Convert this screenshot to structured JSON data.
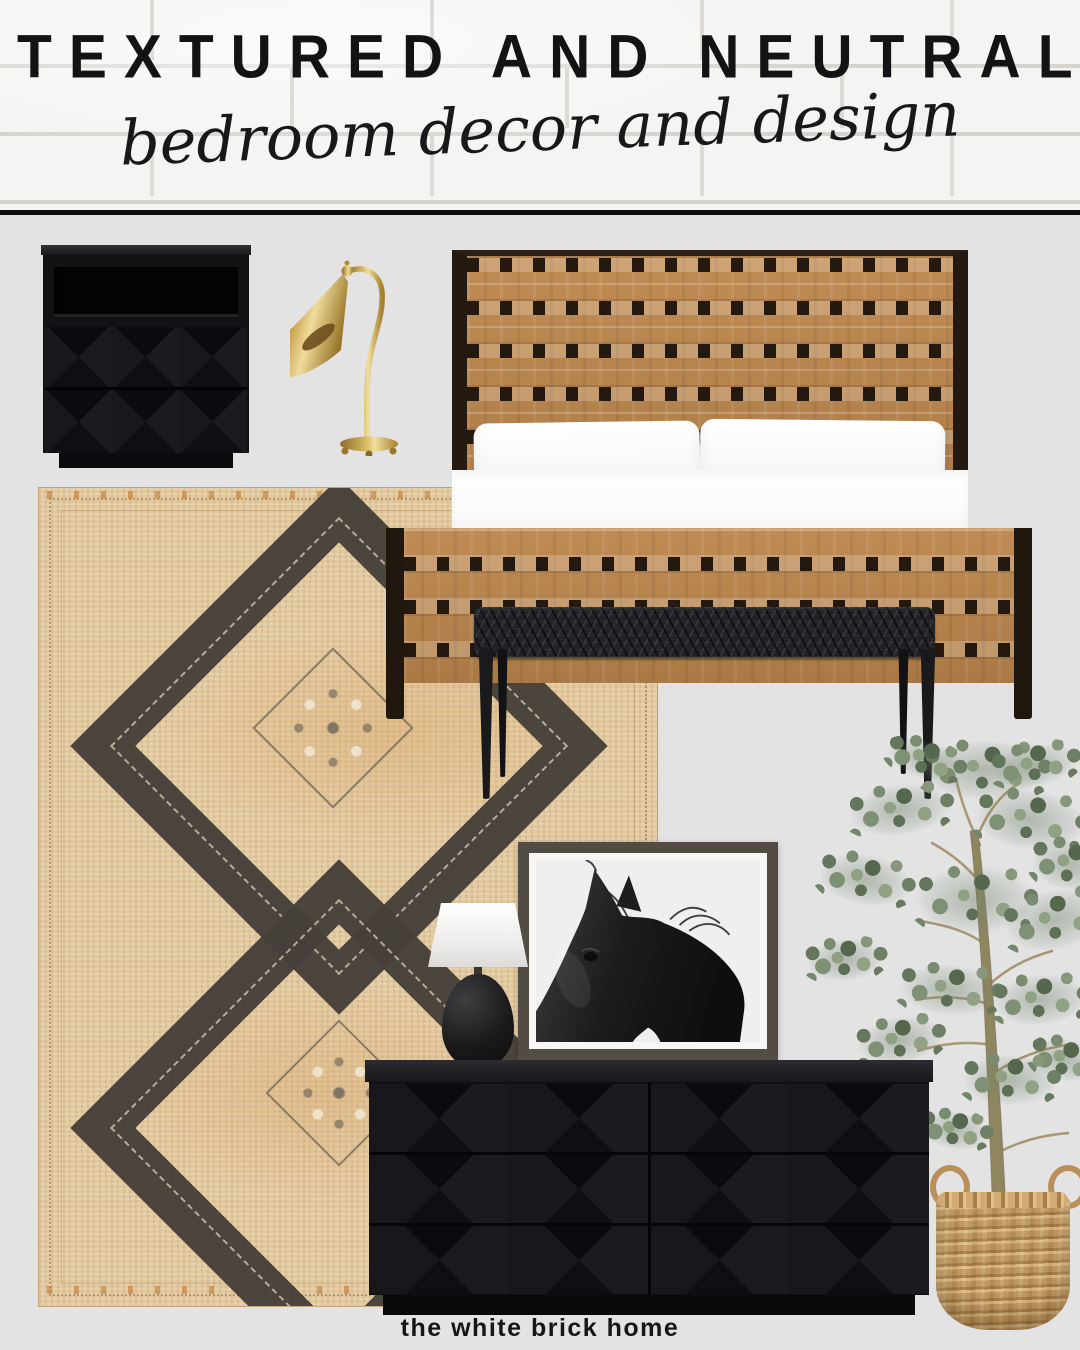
{
  "header": {
    "title": "TEXTURED AND NEUTRAL",
    "subtitle": "bedroom decor and design"
  },
  "footer": {
    "brand": "the white brick home"
  },
  "palette": {
    "canvas_bg": "#e3e3e4",
    "header_bg": "#f5f4f2",
    "ink": "#131313",
    "leather": "#b5824e",
    "leather_frame": "#241a12",
    "rug_base": "#e2c89d",
    "rug_pattern": "#45403a",
    "black_furniture": "#121214",
    "brass": "#c7a54f",
    "foliage_green": "#6f8268",
    "basket_tan": "#c59c63",
    "photo_bg": "#efefee",
    "art_frame": "#534c45",
    "pillow_white": "#fdfdfc"
  }
}
